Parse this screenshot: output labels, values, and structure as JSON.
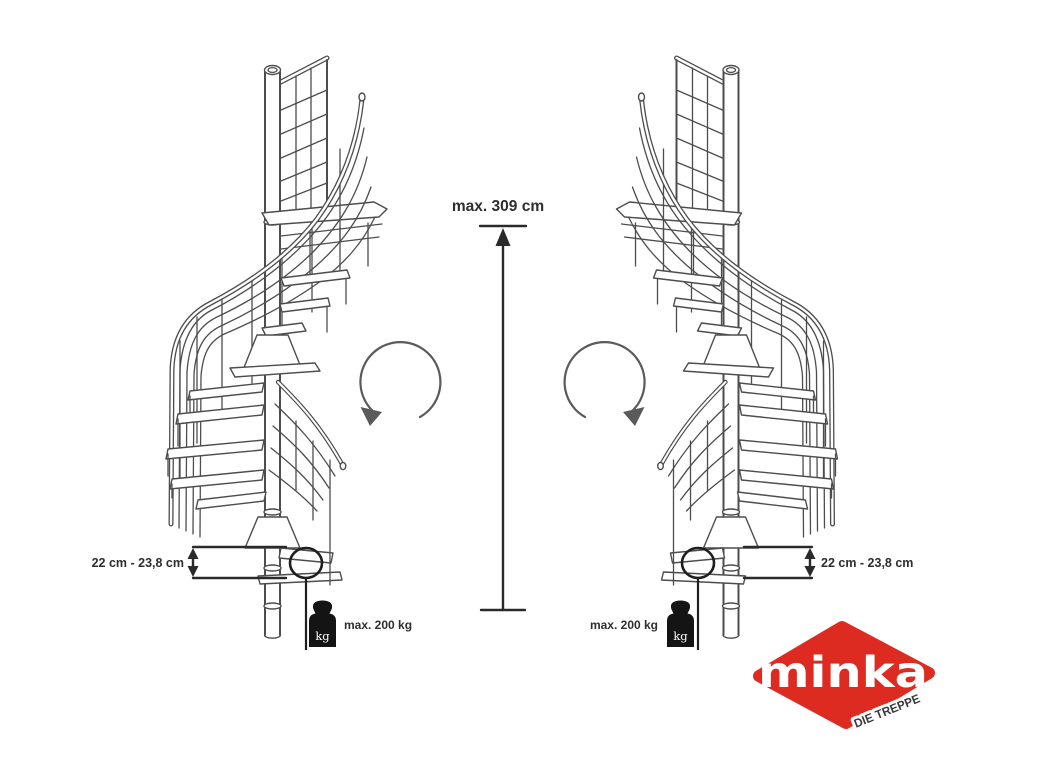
{
  "diagram": {
    "height_dimension": {
      "label": "max. 309 cm"
    },
    "step_height_dimension": {
      "label": "22 cm - 23,8 cm"
    },
    "load_dimension": {
      "label": "max. 200 kg",
      "unit": "kg"
    },
    "icons": {
      "rotation_left": "counterclockwise-rotation-arrow-icon",
      "rotation_right": "clockwise-rotation-arrow-icon",
      "weight": "kettlebell-weight-icon"
    }
  },
  "logo": {
    "brand": "minka",
    "tagline": "DIE TREPPE",
    "brand_color": "#dd2b21"
  },
  "colors": {
    "line_art": "#4d4d4d",
    "annotation": "#2a2a2a",
    "background": "#ffffff"
  }
}
